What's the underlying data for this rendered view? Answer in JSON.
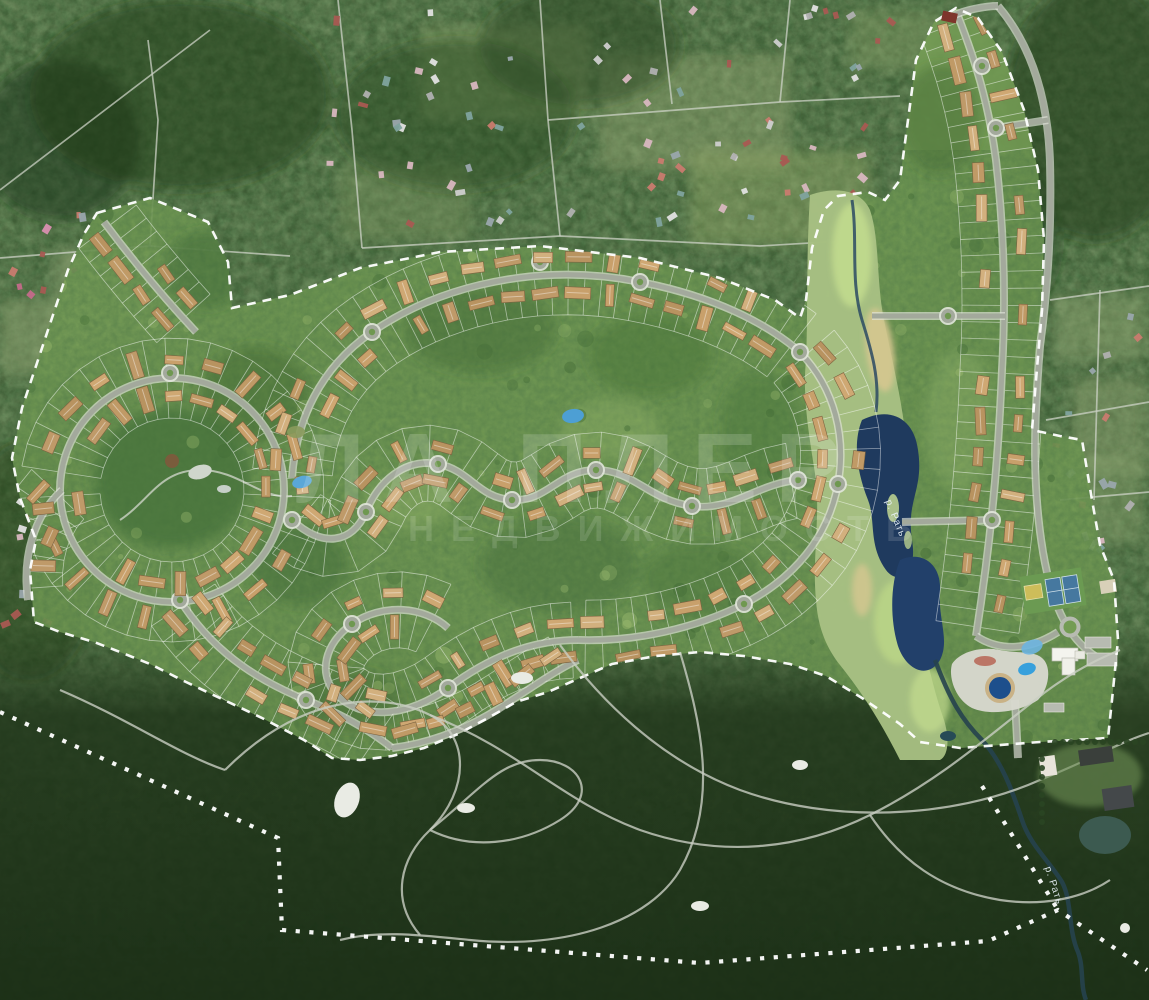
{
  "map": {
    "type": "aerial-masterplan-of-cottage-village",
    "watermark": {
      "line1": "ЛА ПЛЕР",
      "line2": "НЕДВИЖИМОСТЬ"
    },
    "labels": {
      "river_upper": "р. Рать",
      "river_lower": "р. Рать"
    },
    "palette": {
      "forest_base": "#3f5c35",
      "forest_dark": "#22381c",
      "plan_green": "#749c54",
      "road_core": "#a3a99c",
      "road_casing": "#e2e5db",
      "parcel_line": "#ffffff",
      "lake_deep": "#1f3a5e",
      "pond_light": "#5aa7d8",
      "pool_blue": "#1d4f8c",
      "marsh": "#a9c184",
      "sand": "#d6c790",
      "boundary": "#ffffff",
      "house_roofs": [
        "#c8a06b",
        "#c09a66",
        "#cfa873",
        "#b89360",
        "#d2b07e",
        "#bf9a69"
      ],
      "existing_roofs": [
        "#e2e2e2",
        "#cfcfcf",
        "#b0b0b0",
        "#a85a52",
        "#c97b6f",
        "#7fa39e",
        "#9aa7ad",
        "#d8b7c0"
      ],
      "pink_roofs": [
        "#d98fb0",
        "#c46a8a",
        "#d27b9a"
      ]
    }
  }
}
